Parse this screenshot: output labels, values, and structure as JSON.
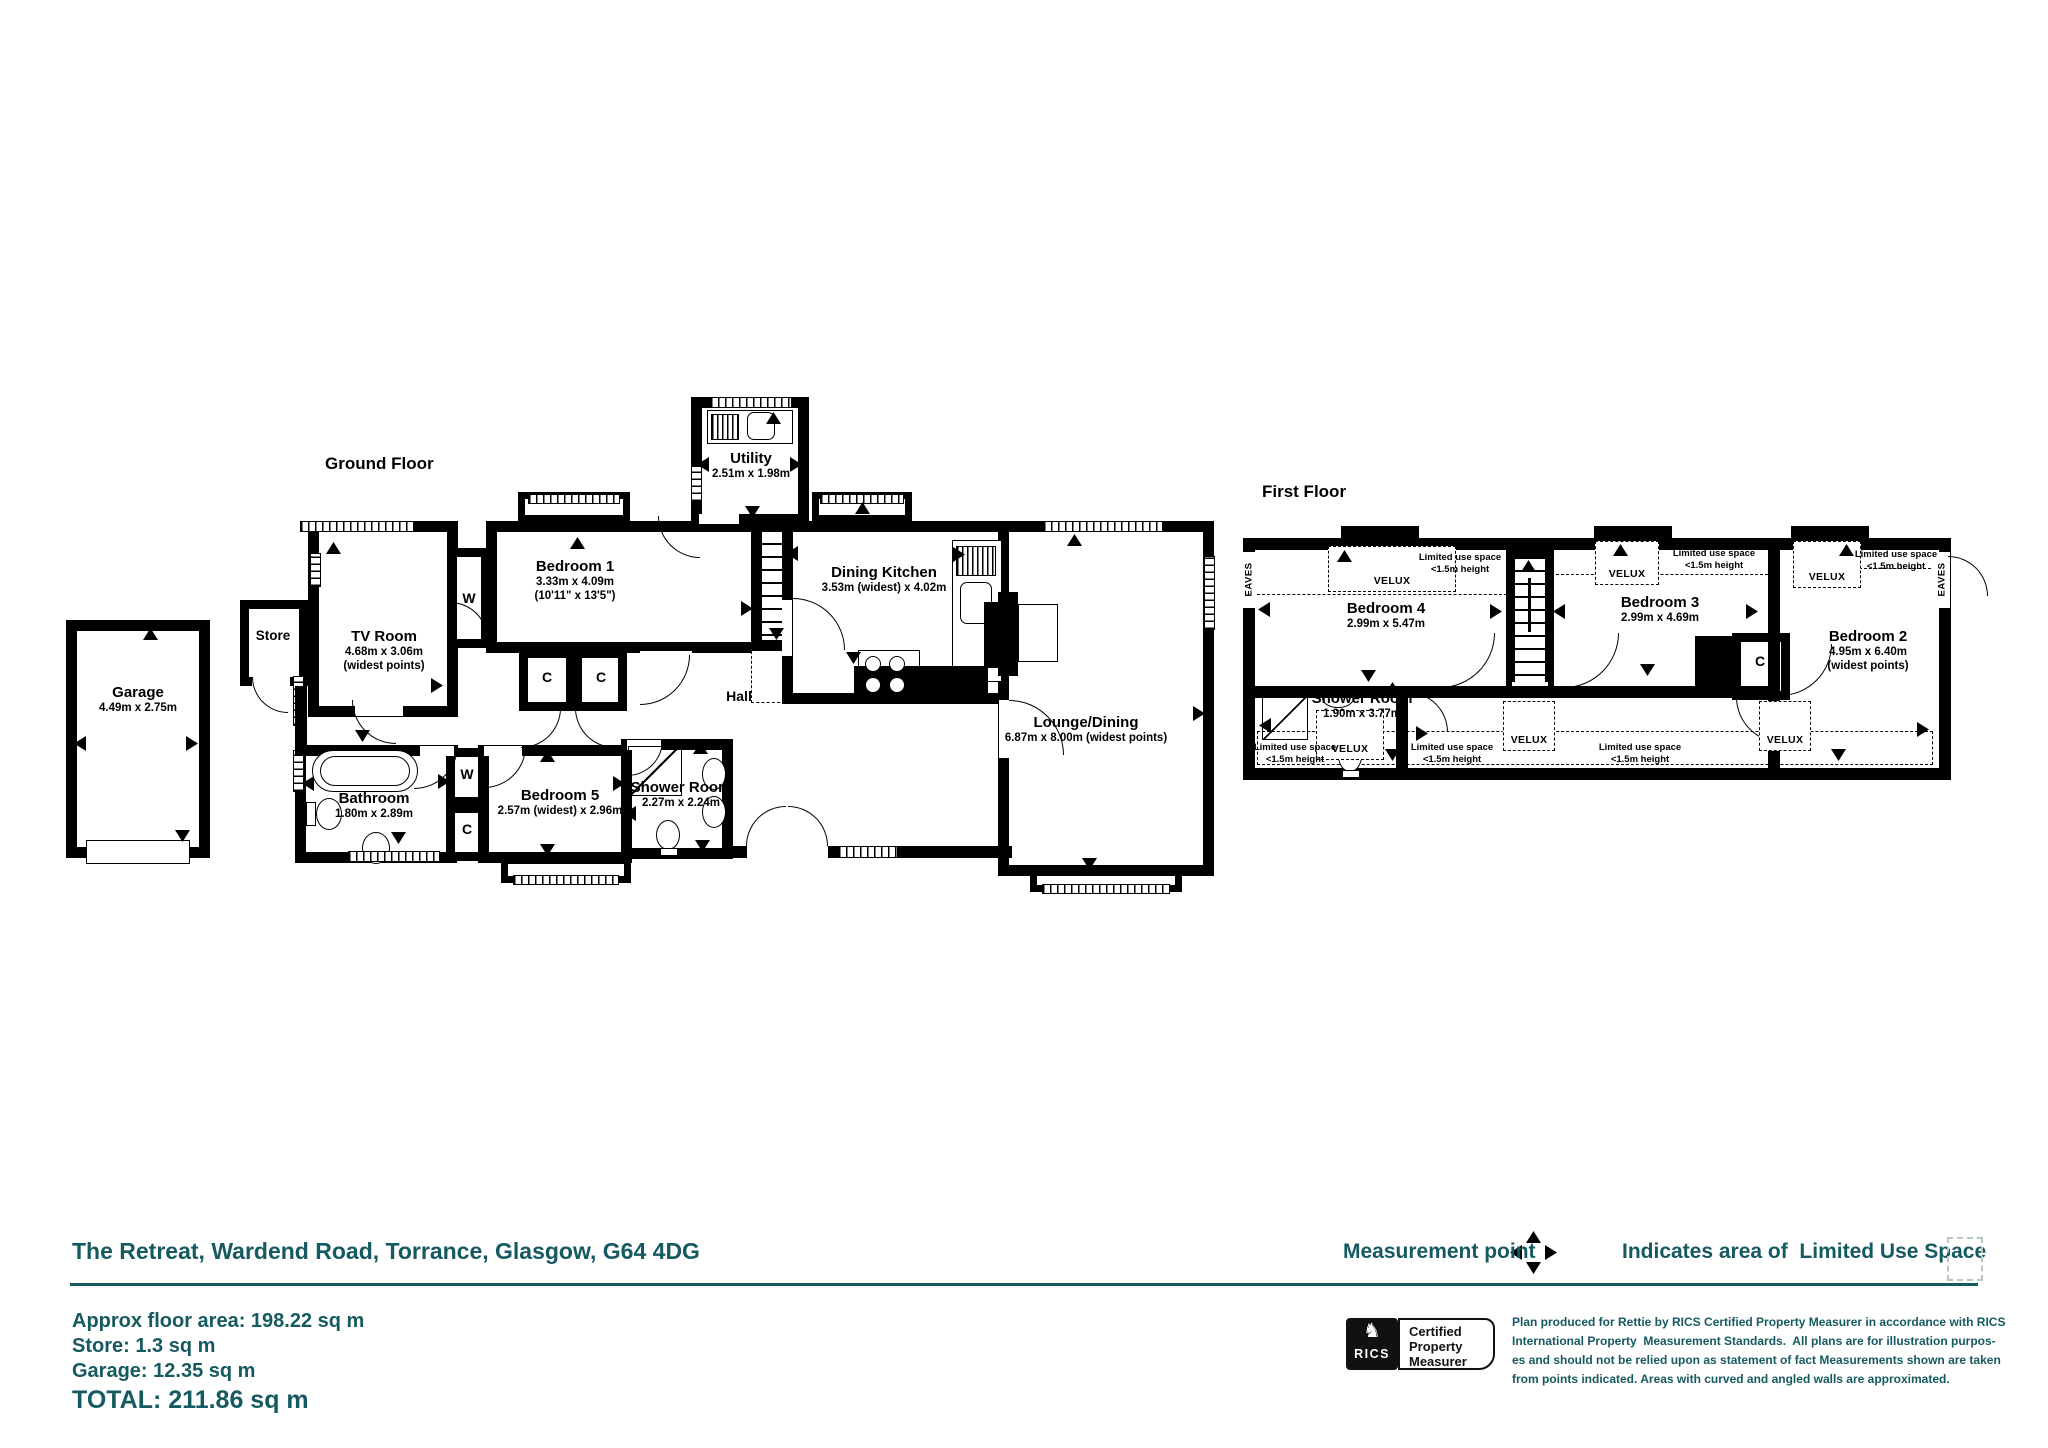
{
  "plan": {
    "ground": {
      "label": "Ground Floor",
      "garage": {
        "name": "Garage",
        "dims": "4.49m x 2.75m"
      },
      "store": {
        "name": "Store"
      },
      "tv": {
        "name": "TV Room",
        "dims": "4.68m x 3.06m",
        "note": "(widest points)"
      },
      "bed1": {
        "name": "Bedroom 1",
        "dims": "3.33m x 4.09m",
        "imperial": "(10'11\" x 13'5\")"
      },
      "utility": {
        "name": "Utility",
        "dims": "2.51m x 1.98m"
      },
      "kitchen": {
        "name": "Dining Kitchen",
        "dims": "3.53m (widest) x 4.02m"
      },
      "hall": {
        "name": "Hall"
      },
      "lounge": {
        "name": "Lounge/Dining",
        "dims": "6.87m x 8.00m (widest points)"
      },
      "bath": {
        "name": "Bathroom",
        "dims": "1.80m x 2.89m"
      },
      "bed5": {
        "name": "Bedroom 5",
        "dims": "2.57m (widest) x 2.96m"
      },
      "shower": {
        "name": "Shower Room",
        "dims": "2.27m x 2.24m"
      },
      "wardrobe": "W",
      "cupboard": "C"
    },
    "first": {
      "label": "First Floor",
      "bed4": {
        "name": "Bedroom 4",
        "dims": "2.99m x 5.47m"
      },
      "bed3": {
        "name": "Bedroom 3",
        "dims": "2.99m x 4.69m"
      },
      "bed2": {
        "name": "Bedroom 2",
        "dims": "4.95m x 6.40m",
        "note": "(widest points)"
      },
      "shower": {
        "name": "Shower Room",
        "dims": "1.90m x 3.77m"
      },
      "cupboard": "C",
      "velux": "VELUX",
      "eaves": "EAVES",
      "limited1": "Limited use space",
      "limited2": "<1.5m height"
    }
  },
  "footer": {
    "address": "The Retreat, Wardend Road, Torrance, Glasgow, G64 4DG",
    "legend": {
      "measurement": "Measurement point",
      "limited": "Indicates area of  Limited Use Space"
    },
    "areas": {
      "approx": "Approx floor area: 198.22 sq m",
      "store": "Store: 1.3 sq m",
      "garage": "Garage: 12.35 sq m",
      "total": "TOTAL: 211.86 sq m"
    },
    "rics": {
      "brand": "RICS",
      "badge1": "Certified",
      "badge2": "Property",
      "badge3": "Measurer"
    },
    "disclaimer": {
      "line1": "Plan produced for Rettie by RICS Certified Property Measurer in accordance with RICS",
      "line2": "International Property  Measurement Standards.  All plans are for illustration purpos-",
      "line3": "es and should not be relied upon as statement of fact Measurements shown are taken",
      "line4": "from points indicated. Areas with curved and angled walls are approximated."
    }
  },
  "colors": {
    "teal": "#165A61",
    "wall": "#000000"
  }
}
